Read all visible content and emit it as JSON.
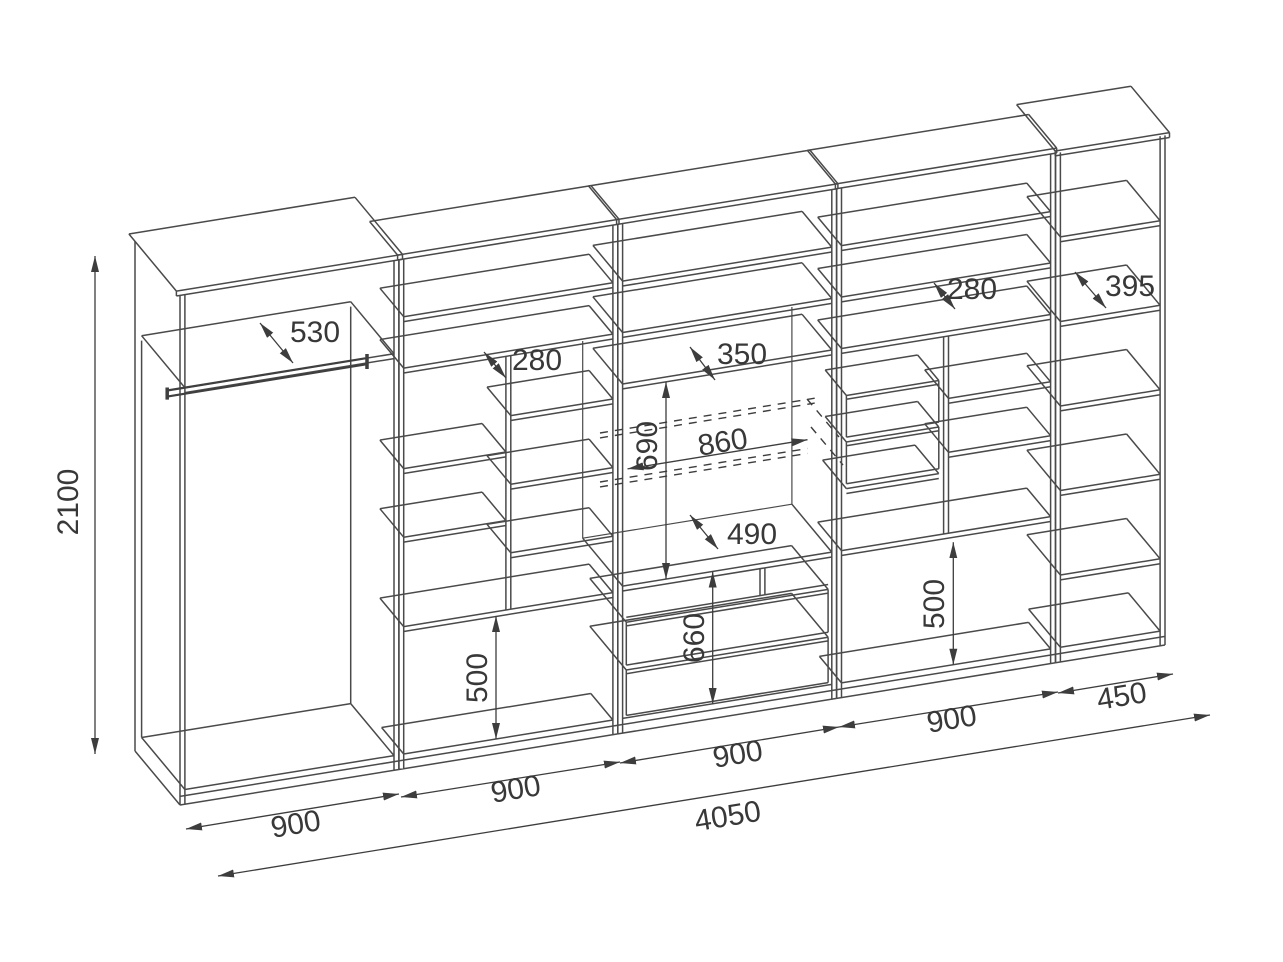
{
  "drawing": {
    "kind": "wall-unit furniture assembly drawing",
    "background_color": "#ffffff",
    "line_color": "#4a4a4a",
    "text_color": "#383838"
  },
  "dims": {
    "total_height": "2100",
    "total_width": "4050",
    "sections": {
      "w1": "900",
      "w2": "900",
      "w3": "900",
      "w4": "900",
      "w5": "450"
    },
    "depths": {
      "wardrobe_top_shelf": "530",
      "section2_shelf": "280",
      "section3_shelf": "350",
      "section4_shelf": "280",
      "section5_shelf": "395",
      "tv_stand_top": "490"
    },
    "tv_niche": {
      "width": "860",
      "height": "690"
    },
    "spans": {
      "drawer_unit_height": "660",
      "section2_base_bay_height": "500",
      "section4_base_bay_height": "500"
    }
  }
}
